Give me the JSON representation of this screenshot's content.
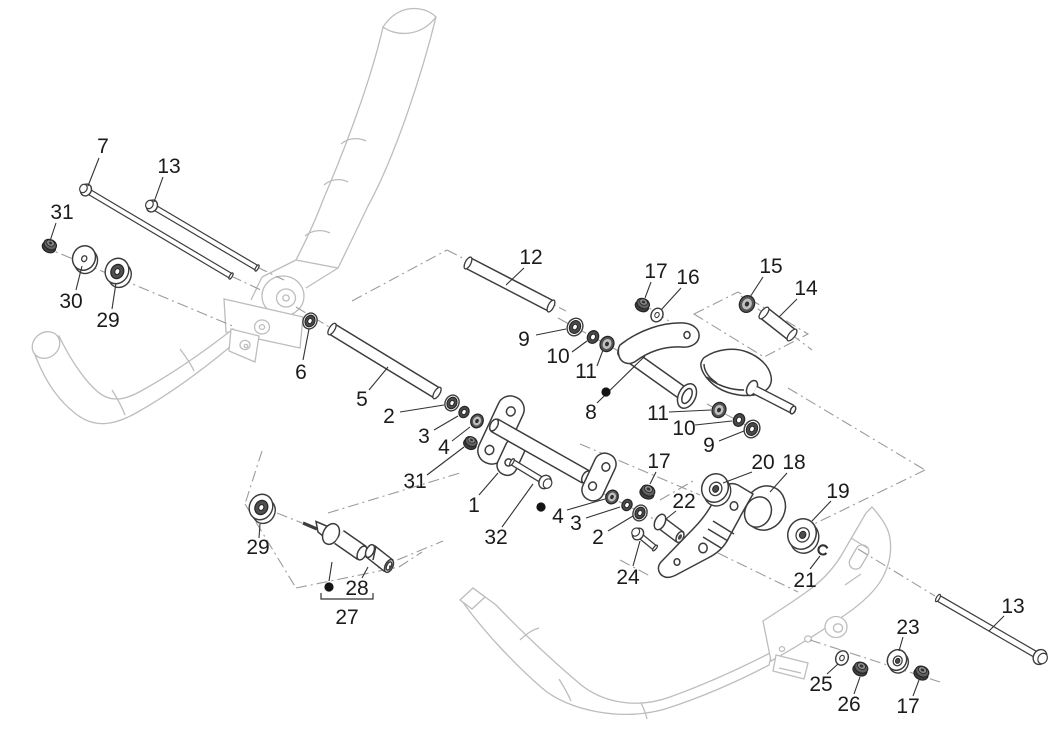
{
  "figure": {
    "width": 1064,
    "height": 740,
    "background": "#ffffff",
    "type": "exploded-parts-diagram"
  },
  "styles": {
    "label_color": "#1b1b1b",
    "label_font_size": 21,
    "leader_color": "#333333",
    "bullet_color": "#141414",
    "dashdot_color": "#9b9b9b",
    "frame_color": "#bdbdbd",
    "part_color": "#3c3c3c"
  },
  "diagram": {
    "axis_lines": [
      [
        42,
        246,
        235,
        327
      ],
      [
        231,
        276,
        263,
        291
      ],
      [
        257,
        267,
        284,
        280
      ],
      [
        296,
        307,
        331,
        328
      ],
      [
        352,
        301,
        447,
        250
      ],
      [
        447,
        250,
        566,
        311
      ],
      [
        558,
        318,
        626,
        355
      ],
      [
        637,
        300,
        696,
        339
      ],
      [
        741,
        296,
        812,
        350
      ],
      [
        788,
        388,
        925,
        470
      ],
      [
        925,
        470,
        808,
        527
      ],
      [
        718,
        553,
        798,
        592
      ],
      [
        660,
        500,
        693,
        481
      ],
      [
        707,
        404,
        762,
        434
      ],
      [
        620,
        560,
        650,
        576
      ],
      [
        810,
        640,
        940,
        682
      ],
      [
        858,
        549,
        935,
        596
      ],
      [
        600,
        492,
        660,
        522
      ],
      [
        580,
        444,
        700,
        495
      ],
      [
        277,
        513,
        302,
        523
      ],
      [
        262,
        451,
        245,
        504
      ],
      [
        245,
        504,
        296,
        588
      ],
      [
        296,
        588,
        399,
        567
      ],
      [
        399,
        567,
        422,
        552
      ],
      [
        328,
        513,
        460,
        473
      ],
      [
        378,
        568,
        443,
        541
      ]
    ],
    "zones": [
      [
        [
          694,
          314
        ],
        [
          738,
          292
        ],
        [
          808,
          334
        ],
        [
          764,
          357
        ]
      ]
    ],
    "rods": [
      {
        "name": "rod-5",
        "x1": 332,
        "y1": 329,
        "x2": 437,
        "y2": 393,
        "d": 10
      },
      {
        "name": "rod-12",
        "x1": 468,
        "y1": 263,
        "x2": 551,
        "y2": 306,
        "d": 10
      },
      {
        "name": "rod-14",
        "x1": 764,
        "y1": 313,
        "x2": 792,
        "y2": 335,
        "d": 11
      }
    ],
    "bolts": [
      {
        "name": "bolt-7",
        "hx": 86,
        "hy": 190,
        "tx": 231,
        "ty": 276,
        "d": 4
      },
      {
        "name": "bolt-13-upper",
        "hx": 152,
        "hy": 206,
        "tx": 257,
        "ty": 268,
        "d": 4
      },
      {
        "name": "bolt-13-lower",
        "hx": 1040,
        "hy": 657,
        "tx": 938,
        "ty": 598,
        "d": 5
      },
      {
        "name": "bolt-32",
        "hx": 545,
        "hy": 482,
        "tx": 512,
        "ty": 462,
        "d": 4.5
      },
      {
        "name": "bolt-24",
        "hx": 638,
        "hy": 534,
        "tx": 655,
        "ty": 548,
        "d": 4
      }
    ],
    "hardware": [
      {
        "name": "nut-31-left",
        "type": "nut",
        "x": 50,
        "y": 245,
        "s": 0.95
      },
      {
        "name": "washer-30",
        "type": "disc",
        "x": 84,
        "y": 258,
        "r": 12.5,
        "hole": "plain"
      },
      {
        "name": "bushing-29-upper",
        "type": "cup",
        "x": 117,
        "y": 271,
        "s": 1
      },
      {
        "name": "washer-6",
        "type": "flanged",
        "x": 310,
        "y": 321,
        "s": 0.9
      },
      {
        "name": "washer-9-left",
        "type": "flanged",
        "x": 575,
        "y": 327,
        "s": 1
      },
      {
        "name": "washer-10-left",
        "type": "ring",
        "x": 593,
        "y": 337,
        "s": 1
      },
      {
        "name": "bushing-11-left",
        "type": "bushing",
        "x": 607,
        "y": 344,
        "s": 1
      },
      {
        "name": "nut-17-top",
        "type": "nut",
        "x": 643,
        "y": 304,
        "s": 0.95
      },
      {
        "name": "washer-16",
        "type": "washer",
        "x": 657,
        "y": 315,
        "s": 1
      },
      {
        "name": "bushing-15",
        "type": "bushing",
        "x": 747,
        "y": 304,
        "s": 1.1
      },
      {
        "name": "bushing-11-right",
        "type": "bushing",
        "x": 719,
        "y": 410,
        "s": 1
      },
      {
        "name": "washer-10-right",
        "type": "ring",
        "x": 739,
        "y": 420,
        "s": 1
      },
      {
        "name": "washer-9-right",
        "type": "flanged",
        "x": 752,
        "y": 429,
        "s": 1
      },
      {
        "name": "nut-17-mid",
        "type": "nut",
        "x": 648,
        "y": 491,
        "s": 1
      },
      {
        "name": "washer-20",
        "type": "disc",
        "x": 715,
        "y": 488,
        "r": 14.5,
        "hole": "ring"
      },
      {
        "name": "washer-19",
        "type": "disc",
        "x": 802,
        "y": 534,
        "r": 15.5,
        "hole": "ring"
      },
      {
        "name": "clip-21",
        "type": "clip",
        "x": 823,
        "y": 550,
        "s": 1
      },
      {
        "name": "washer-2-left",
        "type": "flanged",
        "x": 452,
        "y": 403,
        "s": 0.9
      },
      {
        "name": "ring-3-left",
        "type": "ring",
        "x": 464,
        "y": 412,
        "s": 0.9
      },
      {
        "name": "bushing-4-left",
        "type": "bushing",
        "x": 477,
        "y": 421,
        "s": 0.9
      },
      {
        "name": "nut-31-center",
        "type": "nut",
        "x": 471,
        "y": 442,
        "s": 0.9
      },
      {
        "name": "bushing-4-right",
        "type": "bushing",
        "x": 612,
        "y": 497,
        "s": 0.9
      },
      {
        "name": "ring-3-right",
        "type": "ring",
        "x": 627,
        "y": 505,
        "s": 0.9
      },
      {
        "name": "washer-2-right",
        "type": "flanged",
        "x": 640,
        "y": 513,
        "s": 0.9
      },
      {
        "name": "washer-25",
        "type": "washer",
        "x": 842,
        "y": 658,
        "s": 1.05
      },
      {
        "name": "nut-26",
        "type": "nut",
        "x": 861,
        "y": 668,
        "s": 1
      },
      {
        "name": "washer-23",
        "type": "disc",
        "x": 897,
        "y": 660,
        "r": 10.5,
        "hole": "ring"
      },
      {
        "name": "nut-17-bottom",
        "type": "nut",
        "x": 922,
        "y": 672,
        "s": 1
      },
      {
        "name": "bushing-29-lower",
        "type": "cup",
        "x": 261,
        "y": 507,
        "s": 1
      }
    ],
    "callouts": [
      {
        "label": "7",
        "x": 103,
        "y": 146,
        "leader": [
          [
            99,
            158
          ],
          [
            88,
            186
          ]
        ]
      },
      {
        "label": "13",
        "x": 169,
        "y": 166,
        "leader": [
          [
            163,
            177
          ],
          [
            154,
            202
          ]
        ]
      },
      {
        "label": "31",
        "x": 62,
        "y": 212,
        "leader": [
          [
            56,
            223
          ],
          [
            50,
            241
          ]
        ]
      },
      {
        "label": "30",
        "x": 71,
        "y": 301,
        "leader": [
          [
            76,
            290
          ],
          [
            82,
            266
          ]
        ]
      },
      {
        "label": "29",
        "x": 108,
        "y": 320,
        "leader": [
          [
            112,
            309
          ],
          [
            116,
            283
          ]
        ]
      },
      {
        "label": "12",
        "x": 531,
        "y": 257,
        "leader": [
          [
            524,
            268
          ],
          [
            506,
            285
          ]
        ]
      },
      {
        "label": "17",
        "x": 656,
        "y": 271,
        "leader": [
          [
            651,
            282
          ],
          [
            645,
            298
          ]
        ]
      },
      {
        "label": "16",
        "x": 688,
        "y": 277,
        "leader": [
          [
            681,
            288
          ],
          [
            661,
            310
          ]
        ]
      },
      {
        "label": "15",
        "x": 771,
        "y": 266,
        "leader": [
          [
            763,
            277
          ],
          [
            750,
            297
          ]
        ]
      },
      {
        "label": "14",
        "x": 806,
        "y": 288,
        "leader": [
          [
            797,
            299
          ],
          [
            779,
            317
          ]
        ]
      },
      {
        "label": "6",
        "x": 301,
        "y": 372,
        "leader": [
          [
            303,
            360
          ],
          [
            309,
            329
          ]
        ]
      },
      {
        "label": "5",
        "x": 362,
        "y": 399,
        "leader": [
          [
            369,
            390
          ],
          [
            388,
            367
          ]
        ]
      },
      {
        "label": "9",
        "x": 524,
        "y": 339,
        "leader": [
          [
            536,
            335
          ],
          [
            566,
            329
          ]
        ]
      },
      {
        "label": "10",
        "x": 558,
        "y": 356,
        "leader": [
          [
            572,
            352
          ],
          [
            587,
            341
          ]
        ]
      },
      {
        "label": "11",
        "x": 586,
        "y": 371,
        "leader": [
          [
            597,
            366
          ],
          [
            603,
            350
          ]
        ]
      },
      {
        "label": "8",
        "x": 591,
        "y": 412,
        "leader": [
          [
            597,
            403
          ],
          [
            645,
            356
          ]
        ],
        "bullet": [
          606,
          392
        ]
      },
      {
        "label": "2",
        "x": 389,
        "y": 416,
        "leader": [
          [
            400,
            412
          ],
          [
            444,
            405
          ]
        ]
      },
      {
        "label": "3",
        "x": 424,
        "y": 436,
        "leader": [
          [
            434,
            430
          ],
          [
            458,
            416
          ]
        ]
      },
      {
        "label": "4",
        "x": 444,
        "y": 447,
        "leader": [
          [
            452,
            441
          ],
          [
            470,
            427
          ]
        ]
      },
      {
        "label": "31",
        "x": 415,
        "y": 481,
        "leader": [
          [
            427,
            475
          ],
          [
            464,
            447
          ]
        ]
      },
      {
        "label": "1",
        "x": 474,
        "y": 505,
        "leader": [
          [
            479,
            495
          ],
          [
            498,
            473
          ]
        ]
      },
      {
        "label": "32",
        "x": 496,
        "y": 537,
        "leader": [
          [
            502,
            527
          ],
          [
            533,
            484
          ]
        ]
      },
      {
        "label": "11",
        "x": 658,
        "y": 413,
        "leader": [
          [
            669,
            412
          ],
          [
            711,
            410
          ]
        ]
      },
      {
        "label": "10",
        "x": 684,
        "y": 428,
        "leader": [
          [
            695,
            425
          ],
          [
            732,
            421
          ]
        ]
      },
      {
        "label": "9",
        "x": 709,
        "y": 445,
        "leader": [
          [
            719,
            441
          ],
          [
            744,
            431
          ]
        ]
      },
      {
        "label": "17",
        "x": 659,
        "y": 461,
        "leader": [
          [
            656,
            472
          ],
          [
            650,
            484
          ]
        ]
      },
      {
        "label": "20",
        "x": 763,
        "y": 462,
        "leader": [
          [
            752,
            472
          ],
          [
            723,
            483
          ]
        ]
      },
      {
        "label": "18",
        "x": 794,
        "y": 462,
        "leader": [
          [
            787,
            473
          ],
          [
            770,
            492
          ]
        ]
      },
      {
        "label": "19",
        "x": 838,
        "y": 491,
        "leader": [
          [
            831,
            501
          ],
          [
            812,
            521
          ]
        ]
      },
      {
        "label": "22",
        "x": 684,
        "y": 501,
        "leader": [
          [
            676,
            511
          ],
          [
            666,
            519
          ]
        ]
      },
      {
        "label": "21",
        "x": 805,
        "y": 580,
        "leader": [
          [
            810,
            569
          ],
          [
            820,
            556
          ]
        ]
      },
      {
        "label": "24",
        "x": 628,
        "y": 577,
        "leader": [
          [
            633,
            566
          ],
          [
            640,
            541
          ]
        ]
      },
      {
        "label": "4",
        "x": 558,
        "y": 516,
        "leader": [
          [
            567,
            510
          ],
          [
            605,
            499
          ]
        ],
        "bullet": [
          541,
          507
        ]
      },
      {
        "label": "3",
        "x": 576,
        "y": 523,
        "leader": [
          [
            586,
            518
          ],
          [
            620,
            507
          ]
        ]
      },
      {
        "label": "2",
        "x": 598,
        "y": 537,
        "leader": [
          [
            608,
            531
          ],
          [
            633,
            516
          ]
        ]
      },
      {
        "label": "29",
        "x": 258,
        "y": 547,
        "leader": [
          [
            259,
            538
          ],
          [
            260,
            524
          ]
        ]
      },
      {
        "label": "28",
        "x": 357,
        "y": 588,
        "leader": [
          [
            362,
            578
          ],
          [
            368,
            567
          ]
        ]
      },
      {
        "label": "13",
        "x": 1013,
        "y": 606,
        "leader": [
          [
            1004,
            616
          ],
          [
            989,
            631
          ]
        ]
      },
      {
        "label": "23",
        "x": 908,
        "y": 627,
        "leader": [
          [
            903,
            637
          ],
          [
            899,
            651
          ]
        ]
      },
      {
        "label": "25",
        "x": 821,
        "y": 684,
        "leader": [
          [
            827,
            674
          ],
          [
            838,
            664
          ]
        ]
      },
      {
        "label": "26",
        "x": 849,
        "y": 704,
        "leader": [
          [
            854,
            694
          ],
          [
            860,
            677
          ]
        ]
      },
      {
        "label": "17",
        "x": 908,
        "y": 706,
        "leader": [
          [
            913,
            696
          ],
          [
            919,
            680
          ]
        ]
      }
    ],
    "group_bracket": {
      "label": "27",
      "x": 347,
      "y": 617,
      "line": [
        [
          321,
          593
        ],
        [
          321,
          599
        ],
        [
          373,
          599
        ],
        [
          373,
          593
        ]
      ],
      "bullet": [
        329,
        587
      ],
      "bullet_line": [
        [
          329,
          581
        ],
        [
          332,
          562
        ]
      ]
    }
  }
}
